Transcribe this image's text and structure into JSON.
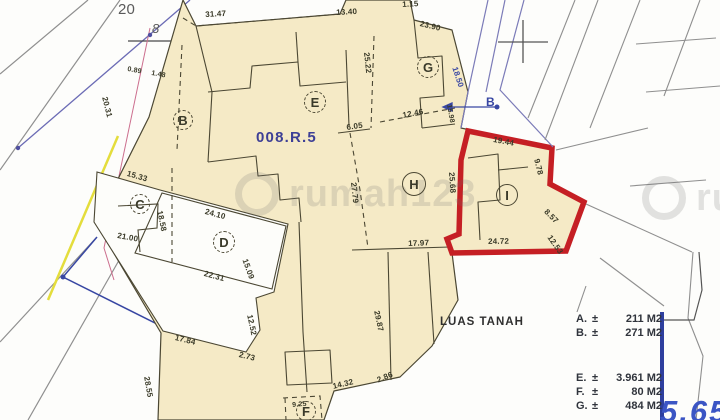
{
  "colors": {
    "parcel_fill": "#f5eac6",
    "boundary": "#4b4733",
    "highlight_red": "#c51f24",
    "road_blue": "#3847a3",
    "legend_bar_blue": "#2e3f9e"
  },
  "watermark": {
    "text": "rumah123"
  },
  "annotations": {
    "big_blue_number": "5.65"
  },
  "labels": [
    {
      "t": "20",
      "x": 118,
      "y": 2,
      "r": 0,
      "s": 15,
      "c": "gray",
      "n": "road-number-label"
    },
    {
      "t": "8",
      "x": 152,
      "y": 22,
      "r": 0,
      "s": 13,
      "c": "gray",
      "italic": true,
      "n": "road-number-label"
    },
    {
      "t": "31.47",
      "x": 205,
      "y": 11,
      "r": -3,
      "s": 8
    },
    {
      "t": "13.40",
      "x": 336,
      "y": 9,
      "r": -3,
      "s": 8
    },
    {
      "t": "1.15",
      "x": 402,
      "y": 1,
      "r": -3,
      "s": 8
    },
    {
      "t": "23.90",
      "x": 421,
      "y": 20,
      "r": 14,
      "s": 8
    },
    {
      "t": "0.89",
      "x": 128,
      "y": 66,
      "r": 10,
      "s": 7
    },
    {
      "t": "1.48",
      "x": 152,
      "y": 70,
      "r": 10,
      "s": 7
    },
    {
      "t": "20.31",
      "x": 108,
      "y": 96,
      "r": 76,
      "s": 8
    },
    {
      "t": "15.33",
      "x": 128,
      "y": 170,
      "r": 16,
      "s": 8
    },
    {
      "t": "18.58",
      "x": 163,
      "y": 210,
      "r": 78,
      "s": 8
    },
    {
      "t": "24.10",
      "x": 206,
      "y": 208,
      "r": 15,
      "s": 8
    },
    {
      "t": "21.00",
      "x": 118,
      "y": 232,
      "r": 10,
      "s": 8
    },
    {
      "t": "22.31",
      "x": 205,
      "y": 270,
      "r": 15,
      "s": 8
    },
    {
      "t": "15.09",
      "x": 248,
      "y": 258,
      "r": 70,
      "s": 8
    },
    {
      "t": "008.R.5",
      "x": 256,
      "y": 130,
      "r": 0,
      "s": 15,
      "c": "purple",
      "n": "plot-reference-label"
    },
    {
      "t": "25.22",
      "x": 370,
      "y": 52,
      "r": 84,
      "s": 8
    },
    {
      "t": "6.05",
      "x": 346,
      "y": 124,
      "r": -8,
      "s": 8
    },
    {
      "t": "12.46",
      "x": 402,
      "y": 112,
      "r": -11,
      "s": 8
    },
    {
      "t": "15.98",
      "x": 452,
      "y": 104,
      "r": 80,
      "s": 7
    },
    {
      "t": "18.50",
      "x": 458,
      "y": 66,
      "r": 72,
      "s": 8,
      "c": "blue"
    },
    {
      "t": "B",
      "x": 486,
      "y": 96,
      "r": 0,
      "s": 12,
      "c": "blue",
      "bold": true,
      "n": "road-name-label"
    },
    {
      "t": "27.79",
      "x": 357,
      "y": 182,
      "r": 84,
      "s": 8
    },
    {
      "t": "19.44",
      "x": 494,
      "y": 136,
      "r": 11,
      "s": 8
    },
    {
      "t": "25.68",
      "x": 455,
      "y": 172,
      "r": 86,
      "s": 8
    },
    {
      "t": "9.78",
      "x": 540,
      "y": 158,
      "r": 76,
      "s": 8
    },
    {
      "t": "8.57",
      "x": 548,
      "y": 208,
      "r": 45,
      "s": 8
    },
    {
      "t": "12.53",
      "x": 552,
      "y": 234,
      "r": 55,
      "s": 8
    },
    {
      "t": "24.72",
      "x": 488,
      "y": 238,
      "r": -1,
      "s": 8
    },
    {
      "t": "17.97",
      "x": 408,
      "y": 240,
      "r": -2,
      "s": 8
    },
    {
      "t": "17.84",
      "x": 176,
      "y": 334,
      "r": 14,
      "s": 8
    },
    {
      "t": "2.73",
      "x": 240,
      "y": 351,
      "r": 14,
      "s": 8
    },
    {
      "t": "12.52",
      "x": 253,
      "y": 314,
      "r": 78,
      "s": 8
    },
    {
      "t": "28.55",
      "x": 150,
      "y": 376,
      "r": 80,
      "s": 8
    },
    {
      "t": "29.87",
      "x": 380,
      "y": 310,
      "r": 78,
      "s": 8
    },
    {
      "t": "14.32",
      "x": 332,
      "y": 383,
      "r": -13,
      "s": 8
    },
    {
      "t": "2.86",
      "x": 376,
      "y": 377,
      "r": -22,
      "s": 8
    },
    {
      "t": "9.25",
      "x": 292,
      "y": 402,
      "r": -5,
      "s": 7
    }
  ],
  "parcels": [
    {
      "letter": "B",
      "x": 173,
      "y": 110,
      "d": 20,
      "style": "dashed"
    },
    {
      "letter": "C",
      "x": 130,
      "y": 194,
      "d": 20,
      "style": "dashed"
    },
    {
      "letter": "D",
      "x": 213,
      "y": 231,
      "d": 22,
      "style": "dashed"
    },
    {
      "letter": "E",
      "x": 304,
      "y": 91,
      "d": 22,
      "style": "dashed"
    },
    {
      "letter": "G",
      "x": 417,
      "y": 56,
      "d": 22,
      "style": "dashed"
    },
    {
      "letter": "H",
      "x": 402,
      "y": 172,
      "d": 24,
      "style": "solid"
    },
    {
      "letter": "I",
      "x": 496,
      "y": 184,
      "d": 22,
      "style": "solid"
    },
    {
      "letter": "F",
      "x": 296,
      "y": 401,
      "d": 20,
      "style": "dashed"
    }
  ],
  "legend": {
    "title": "LUAS TANAH",
    "items": [
      {
        "key": "A.",
        "pm": "±",
        "value": "211 M2",
        "gap": false
      },
      {
        "key": "B.",
        "pm": "±",
        "value": "271 M2",
        "gap": false
      },
      {
        "key": "E.",
        "pm": "±",
        "value": "3.961 M2",
        "gap": true
      },
      {
        "key": "F.",
        "pm": "±",
        "value": "80 M2",
        "gap": false
      },
      {
        "key": "G.",
        "pm": "±",
        "value": "484 M2",
        "gap": false
      }
    ]
  }
}
